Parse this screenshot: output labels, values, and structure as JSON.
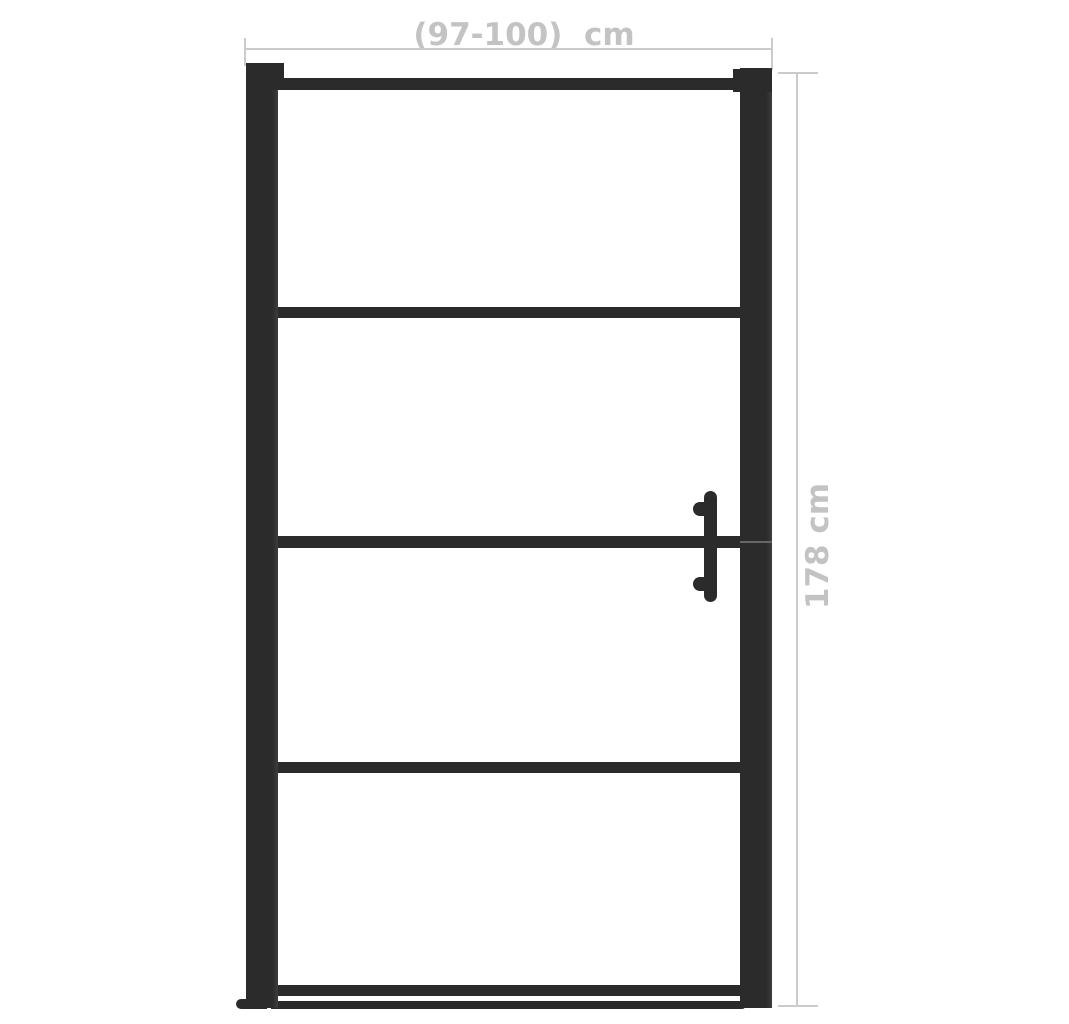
{
  "diagram": {
    "type": "product-dimension-diagram",
    "subject": "framed glass door with four glass panels and vertical handle",
    "glass_panel_count": 4,
    "dimensions": {
      "width_label": "(97-100)  cm",
      "height_label": "178 cm"
    },
    "colors": {
      "bg": "#ffffff",
      "frame": "#2b2b2b",
      "frame_edge": "#3d3d3d",
      "dim_line": "#cbcbcb",
      "dim_text": "#c3c3c3",
      "seam": "#666666"
    }
  }
}
